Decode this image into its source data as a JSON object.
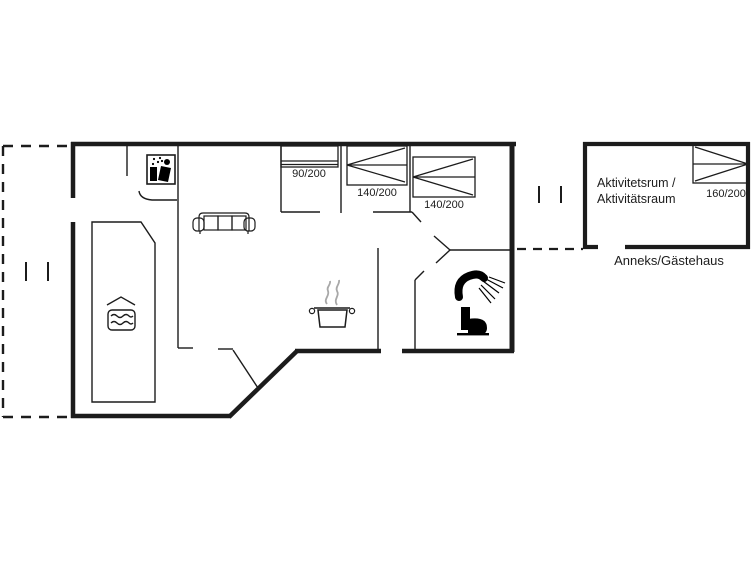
{
  "floorplan": {
    "beds": {
      "bed_90_label": "90/200",
      "bed_140_a_label": "140/200",
      "bed_140_b_label": "140/200",
      "bed_160_label": "160/200"
    },
    "annex": {
      "room_name_line1": "Aktivitetsrum /",
      "room_name_line2": "Aktivitätsraum",
      "caption": "Anneks/Gästehaus"
    },
    "icons": {
      "pool_icon": "water-waves",
      "kitchen_icon": "steaming-pot",
      "bathroom_icons": "shower-and-toilet",
      "utility_icon": "shower-sauna"
    },
    "colors": {
      "line": "#1c1c1c",
      "steam": "#a8a8a8",
      "background": "#ffffff"
    }
  }
}
